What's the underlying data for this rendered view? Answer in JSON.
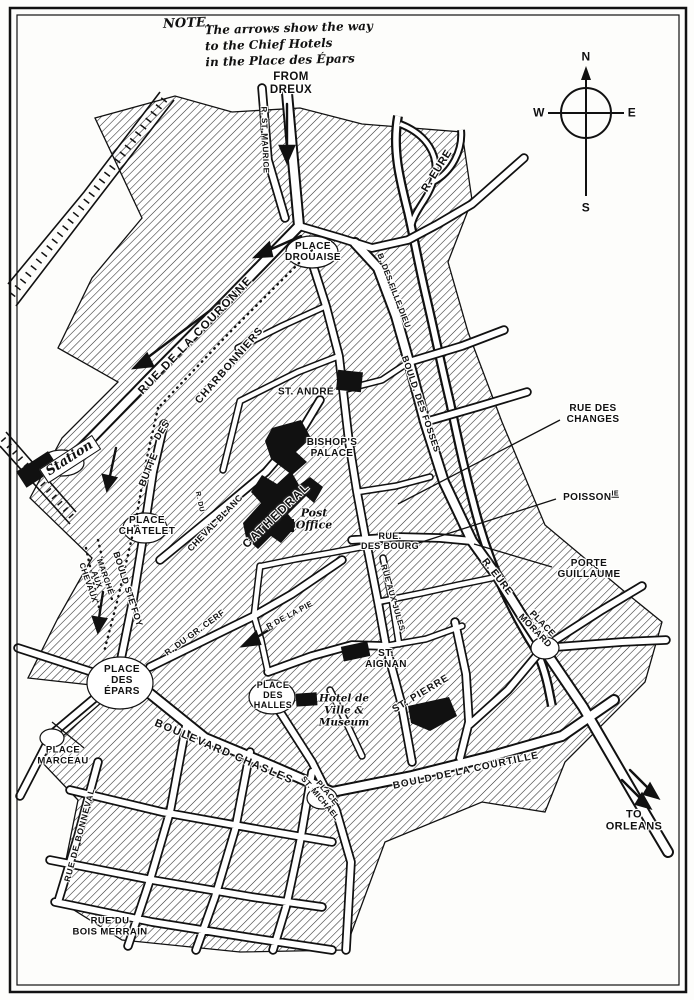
{
  "note": {
    "heading": "NOTE.",
    "body": "The arrows show the way\nto the Chief Hotels\nin the Place des Épars"
  },
  "compass": {
    "north": "N",
    "south": "S",
    "east": "E",
    "west": "W"
  },
  "labels": {
    "from_dreux": "FROM\nDREUX",
    "rue_st_maurice": "R. ST. MAURICE",
    "place_drouaise": "PLACE\nDROUAISE",
    "rue_de_la_couronne": "RUE DE LA COURONNE",
    "charbonniers": "CHARBONNIERS",
    "des": "DES",
    "butte": "BUTTE",
    "r_eure_upper": "R. EURE",
    "fille_dieu": "B. DES FILLE DIEU",
    "bould_des_fosses": "BOULD. DES FOSSES",
    "rue_des_changes": "RUE DES\nCHANGES",
    "poissonnerie_base": "POISSON",
    "poissonnerie_sup": "IE",
    "st_andre": "ST. ANDRÉ",
    "bishops_palace": "BISHOP'S\nPALACE",
    "cathedral": "CATHEDRAL",
    "post_office": "Post\nOffice",
    "cheval_blanc": "CHEVAL BLANC",
    "r_du": "R. DU",
    "station": "Station",
    "place_chatelet": "PLACE\nCHÂTELET",
    "rue_des_bourg": "RUE.\nDES BOURG",
    "porte_guillaume": "PORTE\nGUILLAUME",
    "r_eure_lower": "R. EURE",
    "place_morard": "PLACE\nMORARD",
    "marche_aux_chevaux": "MARCHÉ\nAUX\nCHEVAUX",
    "bould_ste_foy": "BOULD STE FOY",
    "rue_aux_jules": "RUE AUX JULES",
    "r_de_la_pie": "R DE LA PIE",
    "r_du_gr_cerf": "R. DU GR. CERF",
    "place_des_epars": "PLACE\nDES\nÉPARS",
    "place_des_halles": "PLACE\nDES\nHALLES",
    "st_aignan": "ST.\nAIGNAN",
    "hotel_de_ville": "Hotel de\nVille &\nMuseum",
    "st_pierre": "ST. PIERRE",
    "place_st_michael": "PLACE\nST. MICHAEL",
    "place_marceau": "PLACE\nMARCEAU",
    "rue_de_bonneval": "RUE DE BONNEVAL",
    "boulevard_chasles": "BOULEVARD CHASLES",
    "bould_courtille": "BOULD DE LA COURTILLE",
    "rue_du_bois_merrain": "RUE DU\nBOIS MERRAIN",
    "to_orleans": "TO\nORLEANS"
  },
  "colors": {
    "ink": "#111111",
    "paper": "#ffffff"
  }
}
